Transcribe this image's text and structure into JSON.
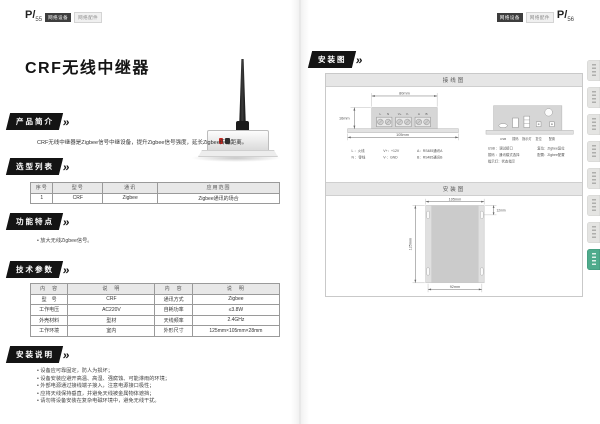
{
  "colors": {
    "ribbon_black": "#141414",
    "accent_tab_green": "#4fab8c",
    "table_header_bg": "#e8e8e8",
    "badge_dark_bg": "#3d3d3d",
    "badge_light_bg": "#f0f0f0"
  },
  "left_page": {
    "page_no_prefix": "P/",
    "page_no": "55",
    "category_badge_dark": "网络设备",
    "category_badge_light": "网络配件",
    "title": "CRF无线中继器",
    "intro": {
      "heading": "产品简介",
      "text": "CRF无线中继器是Zigbee信号中继设备，提升Zigbee信号强度，延长Zigbee传输距离。"
    },
    "selection": {
      "heading": "选型列表",
      "headers": [
        "序号",
        "型号",
        "通讯",
        "应用范围"
      ],
      "rows": [
        [
          "1",
          "CRF",
          "Zigbee",
          "Zigbee通讯的场合"
        ]
      ]
    },
    "features": {
      "heading": "功能特点",
      "items": [
        "放大无线Zigbee信号。"
      ]
    },
    "specs": {
      "heading": "技术参数",
      "headers": [
        "内　容",
        "说　明",
        "内　容",
        "说　明"
      ],
      "rows": [
        [
          "型　号",
          "CRF",
          "通讯方式",
          "Zigbee"
        ],
        [
          "工作电压",
          "AC220V",
          "自耗功率",
          "≤3.8W"
        ],
        [
          "外壳材料",
          "型材",
          "天线频率",
          "2.4GHz"
        ],
        [
          "工作环境",
          "室内",
          "外形尺寸",
          "125mm×105mm×28mm"
        ]
      ]
    },
    "install": {
      "heading": "安装说明",
      "items": [
        "设备应可靠固定，防人为损坏；",
        "设备安装应避开高温、高湿、强腐蚀、可能淋雨的环境；",
        "外部电源通过接线端子接入，注意电源接口极性；",
        "应将天线保持垂直，并避免天线被金属物体遮挡；",
        "请勿将设备安装在复杂电磁环境中，避免无线干扰。"
      ]
    }
  },
  "right_page": {
    "page_no_prefix": "P/",
    "page_no": "56",
    "category_badge_dark": "网络设备",
    "category_badge_light": "网络配件",
    "heading": "安装图",
    "wiring_panel": {
      "title": "接线图",
      "dim_top": "80mm",
      "dim_left": "16mm",
      "dim_bottom": "105mm",
      "terminals": [
        "L",
        "N",
        "V+",
        "V-",
        "A",
        "B"
      ],
      "legend": [
        "L ：火线",
        "N ：零线",
        "V+：+12V",
        "V-：GND",
        "A：RS485通讯A",
        "B：RS485通讯B"
      ],
      "ports": [
        "USB",
        "拨码",
        "指示灯",
        "复位",
        "配置"
      ],
      "port_legend": [
        "USB ：调试接口",
        "拨码 ：通讯模式选择",
        "指示灯：状态指示",
        "复位：Zigbee复位",
        "配置：Zigbee配置"
      ]
    },
    "mounting_panel": {
      "title": "安装图",
      "dim_top": "105mm",
      "dim_right": "12mm",
      "dim_left": "125mm",
      "dim_bottom": "92mm"
    }
  }
}
